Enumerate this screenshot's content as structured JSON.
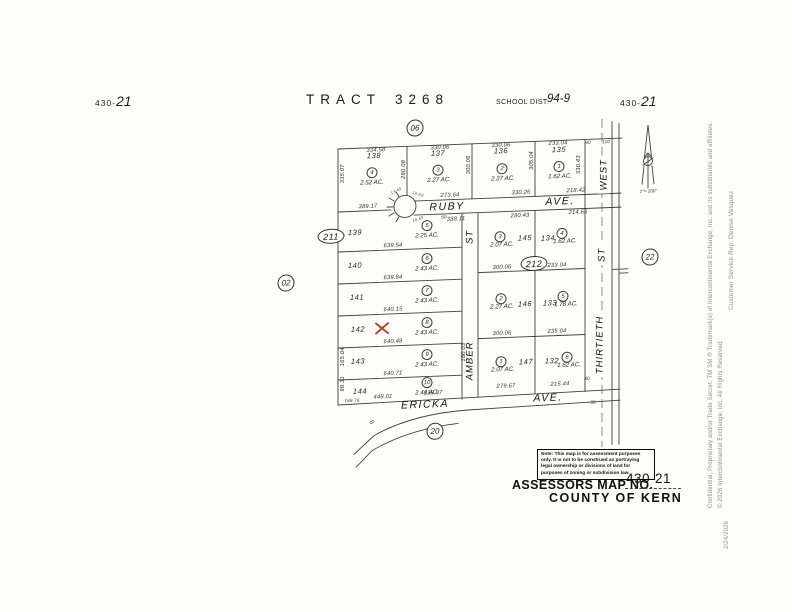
{
  "header": {
    "sheet_prefix": "430-",
    "sheet_number": "21",
    "tract_title": "TRACT",
    "tract_number": "3268",
    "school_district_label": "SCHOOL DIST.",
    "school_district_value": "94-9",
    "section_circle": "06"
  },
  "streets": {
    "ruby": "RUBY",
    "ruby_suffix": "AVE.",
    "amber": "AMBER",
    "amber_suffix": "ST",
    "ericka": "ERICKA",
    "ericka_suffix": "AVE.",
    "west": "WEST",
    "thirtieth": "THIRTIETH",
    "thirtieth_suffix": "ST",
    "curve_label": "8"
  },
  "markers": {
    "c06": "06",
    "c211": "211",
    "c212": "212",
    "c02": "02",
    "c22": "22",
    "c20": "20",
    "north_scale": "1\"= 200'"
  },
  "parcels": [
    {
      "lot": "138",
      "circle": "4",
      "acreage": "2.52 AC."
    },
    {
      "lot": "137",
      "circle": "3",
      "acreage": "2.27 AC."
    },
    {
      "lot": "136",
      "circle": "2",
      "acreage": "2.27 AC."
    },
    {
      "lot": "135",
      "circle": "1",
      "acreage": "1.62 AC."
    },
    {
      "lot": "139",
      "circle": "5",
      "acreage": "2.25 AC."
    },
    {
      "lot": "140",
      "circle": "6",
      "acreage": "2.43 AC."
    },
    {
      "lot": "141",
      "circle": "7",
      "acreage": "2.43 AC."
    },
    {
      "lot": "142",
      "circle": "8",
      "acreage": "2.43 AC."
    },
    {
      "lot": "143",
      "circle": "9",
      "acreage": "2.43 AC."
    },
    {
      "lot": "144",
      "circle": "10",
      "acreage": "2.44 AC."
    },
    {
      "lot": "145",
      "circle": "3",
      "acreage": "2.07 AC."
    },
    {
      "lot": "134",
      "circle": "4",
      "acreage": "1.62 AC."
    },
    {
      "lot": "146",
      "circle": "2",
      "acreage": "2.27 AC."
    },
    {
      "lot": "133",
      "circle": "5",
      "acreage": "1.78 AC."
    },
    {
      "lot": "147",
      "circle": "1",
      "acreage": "2.07 AC."
    },
    {
      "lot": "132",
      "circle": "6",
      "acreage": "1.62 AC."
    }
  ],
  "dims": {
    "t1": "334.58",
    "t2": "330.06",
    "t3": "330.06",
    "t4": "233.04",
    "t40a": "40",
    "t110": "110",
    "rn1": "273.64",
    "rn2": "330.26",
    "rn3": "218.42",
    "rs0": "60",
    "rs1": "338.11",
    "rs2": "280.43",
    "rs3": "214.66",
    "p139": "389.17",
    "l1": "639.54",
    "l2": "639.84",
    "l3": "640.15",
    "l4": "640.48",
    "l5": "640.71",
    "b1": "169.76",
    "b2": "448.01",
    "b3": "338.87",
    "b40": "40",
    "b30": "30",
    "m1": "300.06",
    "m2": "233.04",
    "m3": "300.06",
    "m4": "235.04",
    "m5": "279.67",
    "m6": "215.44",
    "v1": "335.07",
    "v2": "280.08",
    "v3": "300.06",
    "v4": "305.04",
    "v5": "330.43",
    "v6": "165.04",
    "v7": "98.31",
    "v8": "160.03",
    "tiny1": "13.49",
    "tiny2": "16.69",
    "tiny3": "16.69"
  },
  "note": {
    "line1": "Note: This map is for assessment purposes",
    "line2": "only.  It is not to be construed as portraying",
    "line3": "legal ownership or divisions of land for",
    "line4": "purposes of zoning or subdivision law."
  },
  "footer": {
    "assessors_label": "ASSESSORS MAP NO.",
    "map_number": "430-21",
    "county": "COUNTY OF KERN"
  },
  "sidebar": {
    "legal1": "Confidential, Proprietary and/or Trade Secret.  TM SM ® Trademark(s) of Intercontinental Exchange, Inc. and its subsidiaries and affiliates.",
    "legal2": "© 2026 Intercontinental Exchange, Inc.  All Rights Reserved.",
    "rep": "Customer Service Rep:  Denise Vasquez",
    "date": "2/24/2026"
  }
}
